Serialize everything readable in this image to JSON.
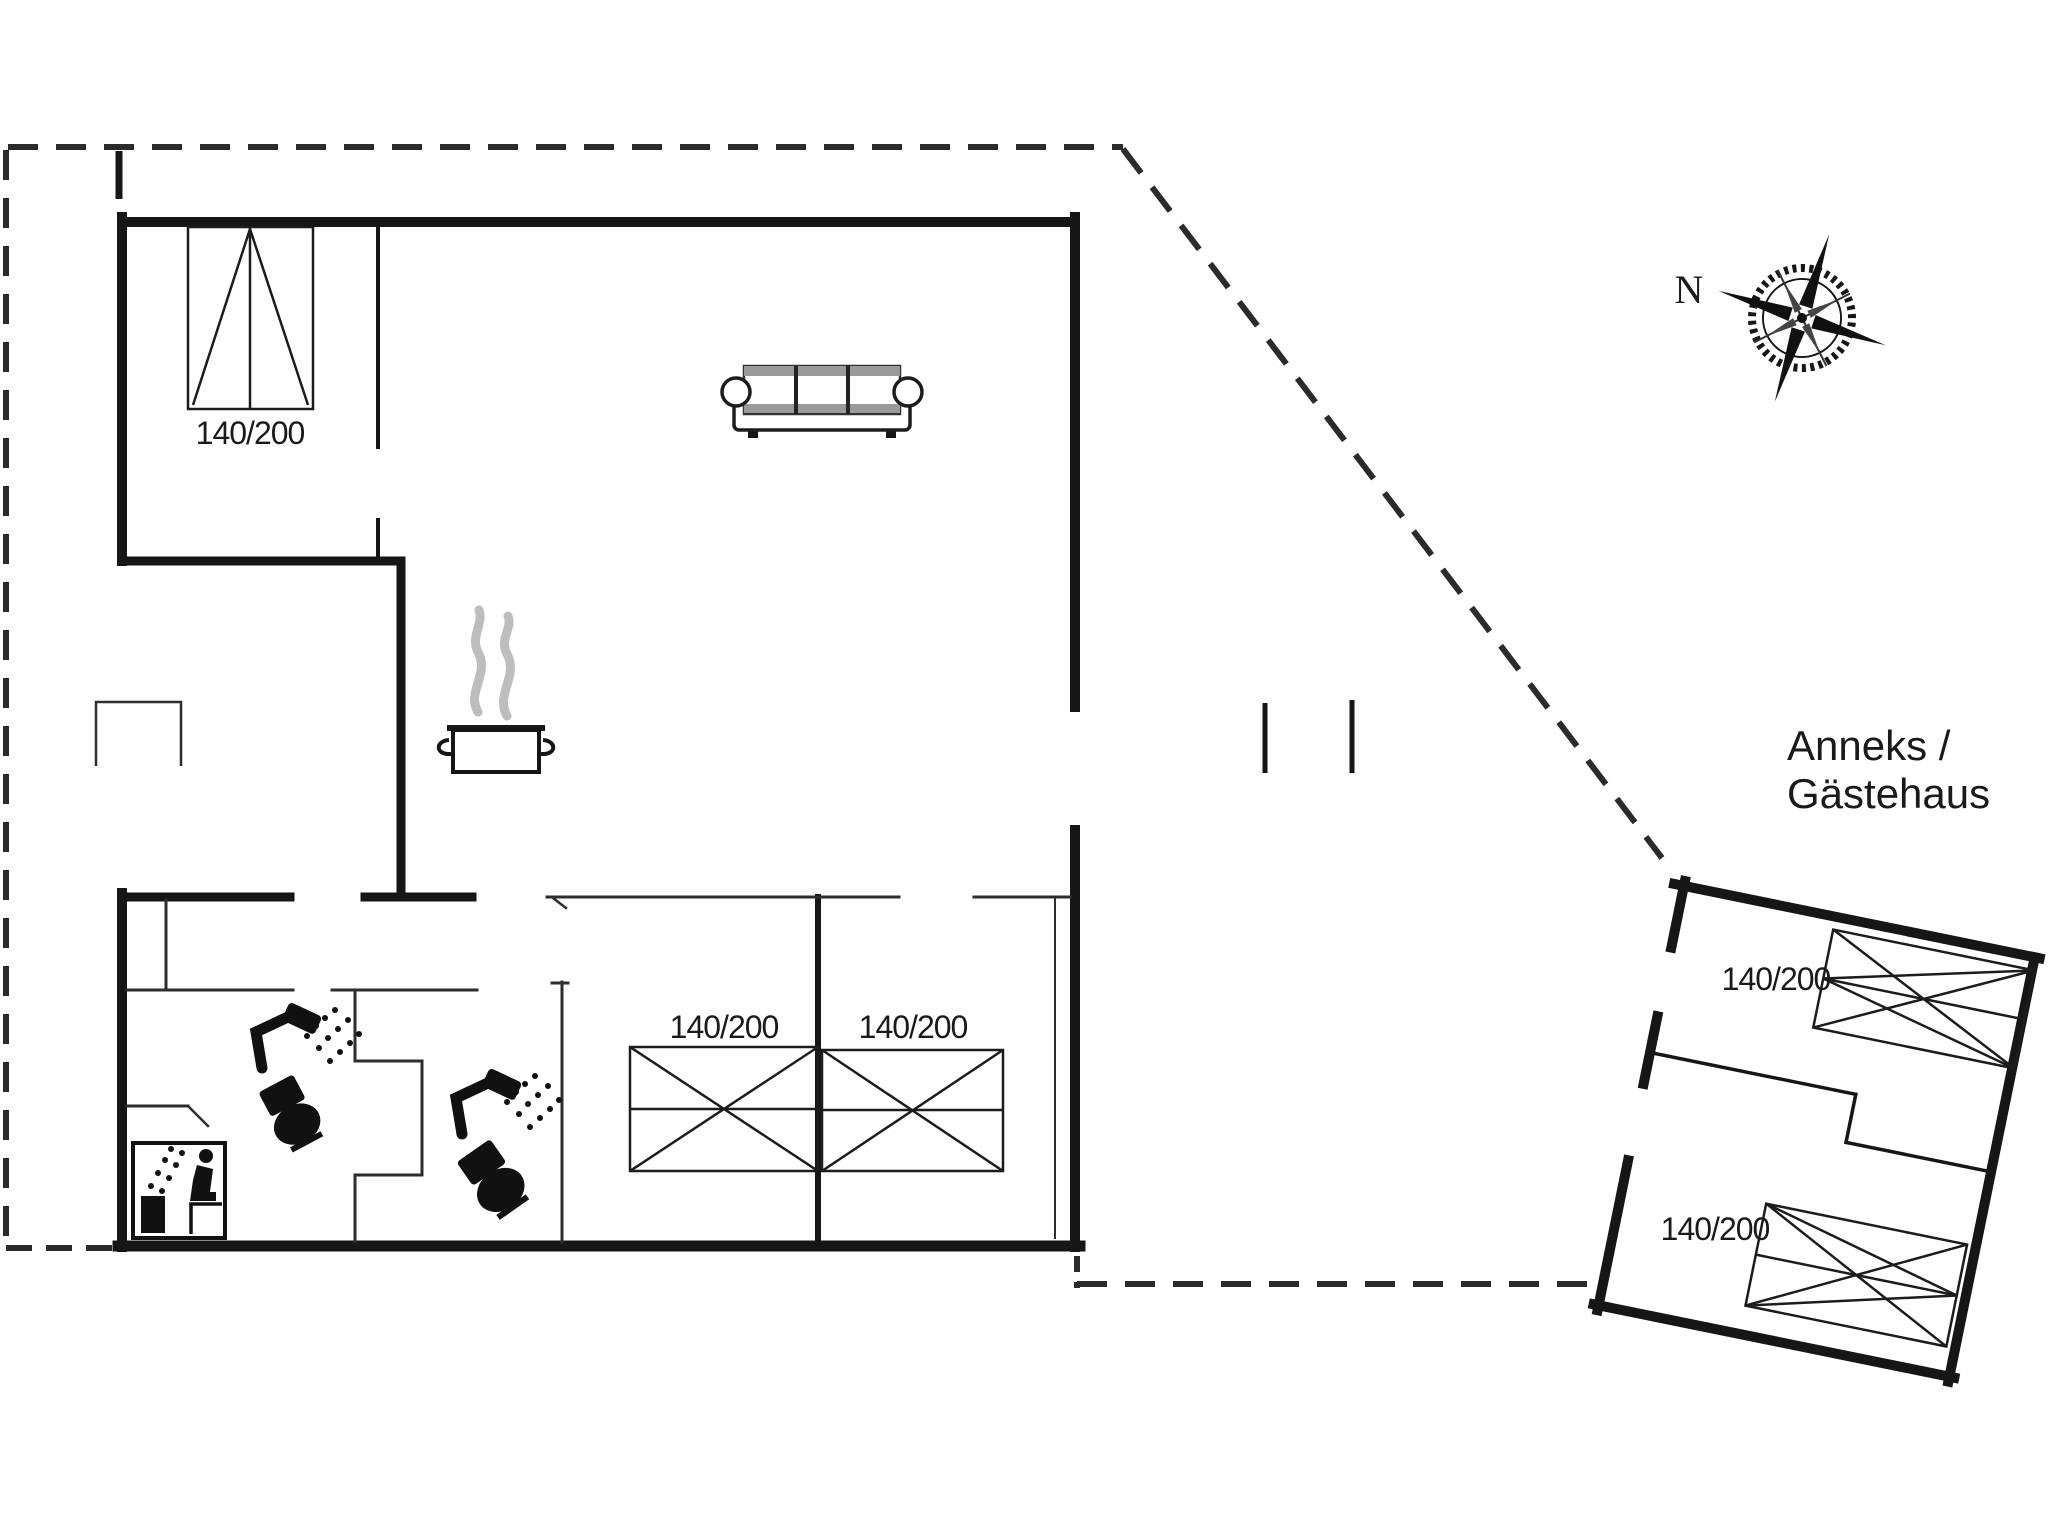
{
  "canvas": {
    "background": "#ffffff",
    "ink": "#161616"
  },
  "colors": {
    "wall": "#161616",
    "thin_wall": "#2e2e2e",
    "dashed_boundary": "#2b2b2b",
    "steam_gray": "#bdbdbd",
    "sofa_gray": "#9a9a9a"
  },
  "labels": {
    "compass_north": "N",
    "annex_title_line1": "Anneks /",
    "annex_title_line2": "Gästehaus"
  },
  "main_house": {
    "bed_top_left_size": "140/200",
    "bed_mid_left_size": "140/200",
    "bed_mid_right_size": "140/200"
  },
  "annex": {
    "bed_top_size": "140/200",
    "bed_bottom_size": "140/200"
  }
}
